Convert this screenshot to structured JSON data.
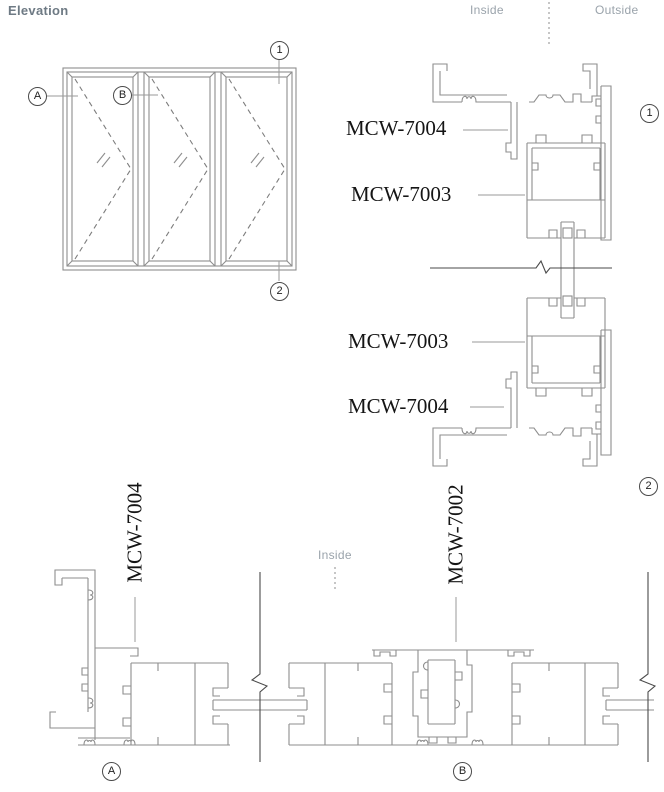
{
  "title": "Elevation",
  "orientation": {
    "inside_top": "Inside",
    "outside_top": "Outside",
    "inside_bottom": "Inside"
  },
  "labels": {
    "head_frame": "MCW-7004",
    "head_sash": "MCW-7003",
    "sill_sash": "MCW-7003",
    "sill_frame": "MCW-7004",
    "jamb_frame": "MCW-7004",
    "meeting_mullion": "MCW-7002"
  },
  "markers": {
    "elev_a": "A",
    "elev_b": "B",
    "elev_top": "1",
    "elev_bottom": "2",
    "detail_head": "1",
    "detail_sill": "2",
    "section_jamb": "A",
    "section_meeting": "B"
  },
  "colors": {
    "line": "#8e8e8e",
    "dark_line": "#4a4a4a",
    "label_text": "#151515",
    "muted_text": "#9aa3ab",
    "title_text": "#6e7a84"
  }
}
